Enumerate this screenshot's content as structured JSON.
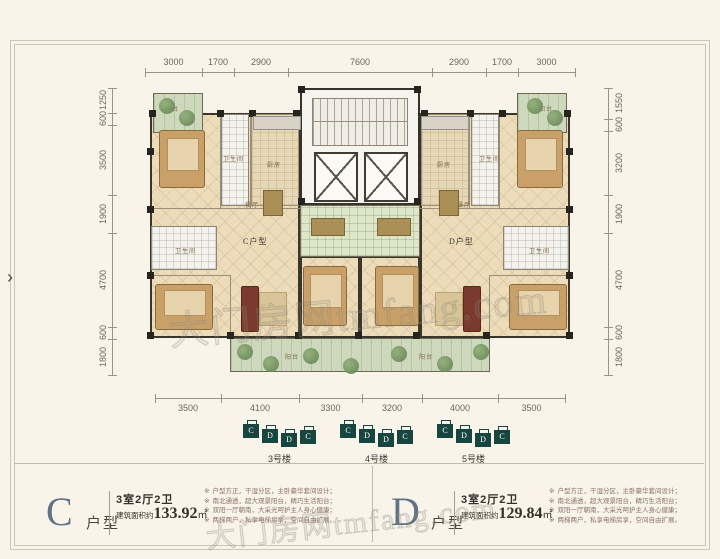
{
  "ui": {
    "bullet": "※",
    "arrow": "›"
  },
  "watermark": {
    "text": "大门房网tmfang.com"
  },
  "dimensions": {
    "top": [
      "3000",
      "1700",
      "2900",
      "7600",
      "2900",
      "1700",
      "3000"
    ],
    "left": [
      "1250",
      "600",
      "3500",
      "1900",
      "4700",
      "600",
      "1800"
    ],
    "right": [
      "1550",
      "600",
      "3200",
      "1900",
      "4700",
      "600",
      "1800"
    ],
    "bottom": [
      "3500",
      "4100",
      "3300",
      "3200",
      "4000",
      "3500"
    ]
  },
  "plan": {
    "unit_c_label": "C户型",
    "unit_d_label": "D户型",
    "room_labels": [
      "阳台",
      "次卧",
      "卫生间",
      "厨房",
      "餐厅",
      "卫生间",
      "主卧",
      "客厅",
      "次卧",
      "阳台",
      "阳台",
      "次卧",
      "卫生间",
      "厨房",
      "餐厅",
      "卫生间",
      "主卧",
      "客厅",
      "次卧",
      "阳台"
    ]
  },
  "buildings": [
    {
      "label": "3号楼",
      "blocks": [
        "C",
        "D",
        "D",
        "C"
      ]
    },
    {
      "label": "4号楼",
      "blocks": [
        "C",
        "D",
        "D",
        "C"
      ]
    },
    {
      "label": "5号楼",
      "blocks": [
        "C",
        "D",
        "D",
        "C"
      ]
    }
  ],
  "units": [
    {
      "letter": "C",
      "suffix": "户型",
      "layout": "3室2厅2卫",
      "area_prefix": "建筑面积约",
      "area": "133.92",
      "area_unit": "㎡",
      "features": [
        "户型方正，干湿分区，主卧豪华套间设计；",
        "南北通透，超大观景阳台，精巧生活阳台；",
        "双阳一厅朝南，大采光呵护主人身心健康；",
        "两梯两户，私享电梯房享，空间自由扩展。"
      ]
    },
    {
      "letter": "D",
      "suffix": "户型",
      "layout": "3室2厅2卫",
      "area_prefix": "建筑面积约",
      "area": "129.84",
      "area_unit": "㎡",
      "features": [
        "户型方正，干湿分区，主卧豪华套间设计；",
        "南北通透，超大观景阳台，精巧生活阳台；",
        "双阳一厅朝南，大采光呵护主人身心健康；",
        "两梯两户，私享电梯房享，空间自由扩展。"
      ]
    }
  ]
}
